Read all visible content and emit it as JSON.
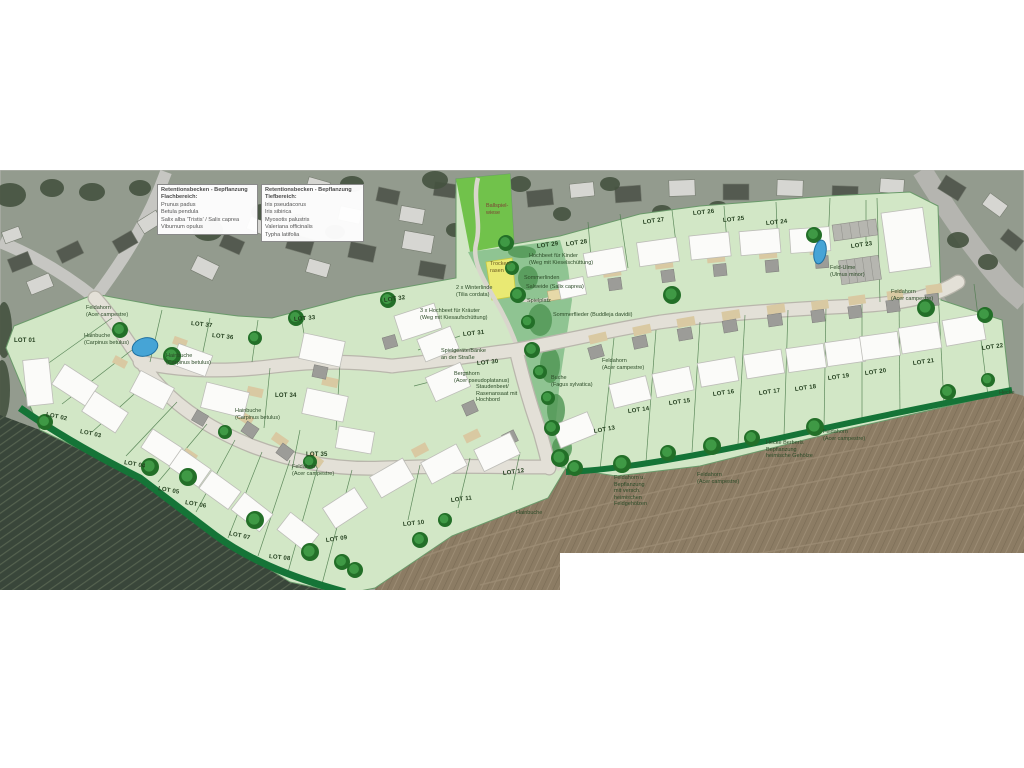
{
  "legend": {
    "boxes": [
      {
        "title": "Retentionsbecken - Bepflanzung Flachbereich:",
        "items": [
          "Prunus padus",
          "Betula pendula",
          "Salix alba 'Tristis' / Salix caprea",
          "Viburnum opulus"
        ]
      },
      {
        "title": "Retentionsbecken - Bepflanzung Tiefbereich:",
        "items": [
          "Iris pseudacorus",
          "Iris sibirica",
          "Myosotis palustris",
          "Valeriana officinalis",
          "Typha latifolia"
        ]
      }
    ]
  },
  "lots": [
    {
      "label": "LOT 01",
      "x": 14,
      "y": 341,
      "r": 0
    },
    {
      "label": "LOT 02",
      "x": 46,
      "y": 415,
      "r": 12
    },
    {
      "label": "LOT 03",
      "x": 80,
      "y": 432,
      "r": 12
    },
    {
      "label": "LOT 04",
      "x": 124,
      "y": 463,
      "r": 10
    },
    {
      "label": "LOT 05",
      "x": 158,
      "y": 489,
      "r": 10
    },
    {
      "label": "LOT 06",
      "x": 185,
      "y": 503,
      "r": 10
    },
    {
      "label": "LOT 07",
      "x": 229,
      "y": 534,
      "r": 12
    },
    {
      "label": "LOT 08",
      "x": 269,
      "y": 557,
      "r": 6
    },
    {
      "label": "LOT 09",
      "x": 326,
      "y": 541,
      "r": -8
    },
    {
      "label": "LOT 10",
      "x": 403,
      "y": 525,
      "r": -6
    },
    {
      "label": "LOT 11",
      "x": 451,
      "y": 501,
      "r": -7
    },
    {
      "label": "LOT 12",
      "x": 503,
      "y": 474,
      "r": -8
    },
    {
      "label": "LOT 13",
      "x": 594,
      "y": 432,
      "r": -10
    },
    {
      "label": "LOT 14",
      "x": 628,
      "y": 412,
      "r": -8
    },
    {
      "label": "LOT 15",
      "x": 669,
      "y": 404,
      "r": -8
    },
    {
      "label": "LOT 16",
      "x": 713,
      "y": 395,
      "r": -8
    },
    {
      "label": "LOT 17",
      "x": 759,
      "y": 394,
      "r": -8
    },
    {
      "label": "LOT 18",
      "x": 795,
      "y": 390,
      "r": -8
    },
    {
      "label": "LOT 19",
      "x": 828,
      "y": 379,
      "r": -8
    },
    {
      "label": "LOT 20",
      "x": 865,
      "y": 374,
      "r": -8
    },
    {
      "label": "LOT 21",
      "x": 913,
      "y": 364,
      "r": -8
    },
    {
      "label": "LOT 22",
      "x": 982,
      "y": 349,
      "r": -8
    },
    {
      "label": "LOT 23",
      "x": 851,
      "y": 247,
      "r": -8
    },
    {
      "label": "LOT 24",
      "x": 766,
      "y": 224,
      "r": -6
    },
    {
      "label": "LOT 25",
      "x": 723,
      "y": 221,
      "r": -6
    },
    {
      "label": "LOT 26",
      "x": 693,
      "y": 214,
      "r": -6
    },
    {
      "label": "LOT 27",
      "x": 643,
      "y": 223,
      "r": -8
    },
    {
      "label": "LOT 28",
      "x": 566,
      "y": 245,
      "r": -8
    },
    {
      "label": "LOT 29",
      "x": 537,
      "y": 247,
      "r": -8
    },
    {
      "label": "LOT 30",
      "x": 477,
      "y": 364,
      "r": -6
    },
    {
      "label": "LOT 31",
      "x": 463,
      "y": 335,
      "r": -6
    },
    {
      "label": "LOT 32",
      "x": 384,
      "y": 301,
      "r": -8
    },
    {
      "label": "LOT 33",
      "x": 294,
      "y": 320,
      "r": -5
    },
    {
      "label": "LOT 34",
      "x": 275,
      "y": 396,
      "r": 0
    },
    {
      "label": "LOT 35",
      "x": 306,
      "y": 455,
      "r": 0
    },
    {
      "label": "LOT 36",
      "x": 212,
      "y": 336,
      "r": 6
    },
    {
      "label": "LOT 37",
      "x": 191,
      "y": 324,
      "r": 6
    }
  ],
  "annotations": [
    {
      "text": "Feldahorn\n(Acer campestre)",
      "x": 86,
      "y": 308
    },
    {
      "text": "Hainbuche\n(Carpinus betulus)",
      "x": 84,
      "y": 336
    },
    {
      "text": "Hainbuche\n(Carpinus betulus)",
      "x": 166,
      "y": 356
    },
    {
      "text": "Hainbuche\n(Carpinus betulus)",
      "x": 235,
      "y": 411
    },
    {
      "text": "Feldahorn\n(Acer campestre)",
      "x": 292,
      "y": 467
    },
    {
      "text": "2 x Winterlinde\n(Tilia cordata)",
      "x": 456,
      "y": 288
    },
    {
      "text": "3 x Hochbeet für Kräuter\n(Weg mit Kiesaufschüttung)",
      "x": 420,
      "y": 311
    },
    {
      "text": "Hochbeet für Kinder\n(Weg mit Kieselschüttung)",
      "x": 529,
      "y": 256
    },
    {
      "text": "Sommerlinden",
      "x": 524,
      "y": 278
    },
    {
      "text": "Salweide (Salix caprea)",
      "x": 526,
      "y": 287
    },
    {
      "text": "Spielplatz",
      "x": 527,
      "y": 301
    },
    {
      "text": "Sommerflieder (Buddleja davidii)",
      "x": 553,
      "y": 315
    },
    {
      "text": "Spielgeräte/Bänke\nan der Straße",
      "x": 441,
      "y": 351
    },
    {
      "text": "Bergahorn\n(Acer pseudoplatanus)",
      "x": 454,
      "y": 374
    },
    {
      "text": "Staudenbeet/\nRasenansaat mit\nHochbord",
      "x": 476,
      "y": 387
    },
    {
      "text": "Buche\n(Fagus sylvatica)",
      "x": 551,
      "y": 378
    },
    {
      "text": "Feldahorn\n(Acer campestre)",
      "x": 602,
      "y": 361
    },
    {
      "text": "Feld-Ulme\n(Ulmus minor)",
      "x": 830,
      "y": 268
    },
    {
      "text": "Feldahorn\n(Acer campestre)",
      "x": 891,
      "y": 292
    },
    {
      "text": "Feldahorn\n(Acer campestre)",
      "x": 823,
      "y": 432
    },
    {
      "text": "Hecke Berberis\nBepflanzung\nheimische Gehölze",
      "x": 766,
      "y": 443
    },
    {
      "text": "Hecke",
      "x": 999,
      "y": 393
    },
    {
      "text": "Feldahorn u.\nBepflanzung\nmit versch.\nheimischen\nFeldgehölzen",
      "x": 614,
      "y": 478
    },
    {
      "text": "Feldahorn\n(Acer campestre)",
      "x": 697,
      "y": 475
    },
    {
      "text": "Hainbuche",
      "x": 516,
      "y": 513
    },
    {
      "text": "Ballspiel-\nwiese",
      "x": 486,
      "y": 206,
      "c": "#7d4334"
    },
    {
      "text": "Trocken-\nrasen",
      "x": 490,
      "y": 264,
      "c": "#6b5a22"
    }
  ],
  "colors": {
    "plan_green": "#d2e7c6",
    "bright_green": "#71c24b",
    "corridor_green": "#8fc492",
    "corridor_dark": "#4e9553",
    "road_fill": "#e3e0d7",
    "road_edge": "#b9b6ac",
    "house_white": "#fbfbf9",
    "garage_grey": "#9c9c98",
    "driveway_tan": "#d9c9a2",
    "hedge_green": "#157437",
    "tree_dark": "#236f28",
    "tree_light": "#3f9945",
    "pond_blue": "#46a4d6",
    "field_brown": "#8c7c64",
    "vineyard_dark": "#39463a",
    "photo_grey": "#939b8e",
    "divider_green": "#4a7a4a",
    "yellow_patch": "#e9e973"
  }
}
